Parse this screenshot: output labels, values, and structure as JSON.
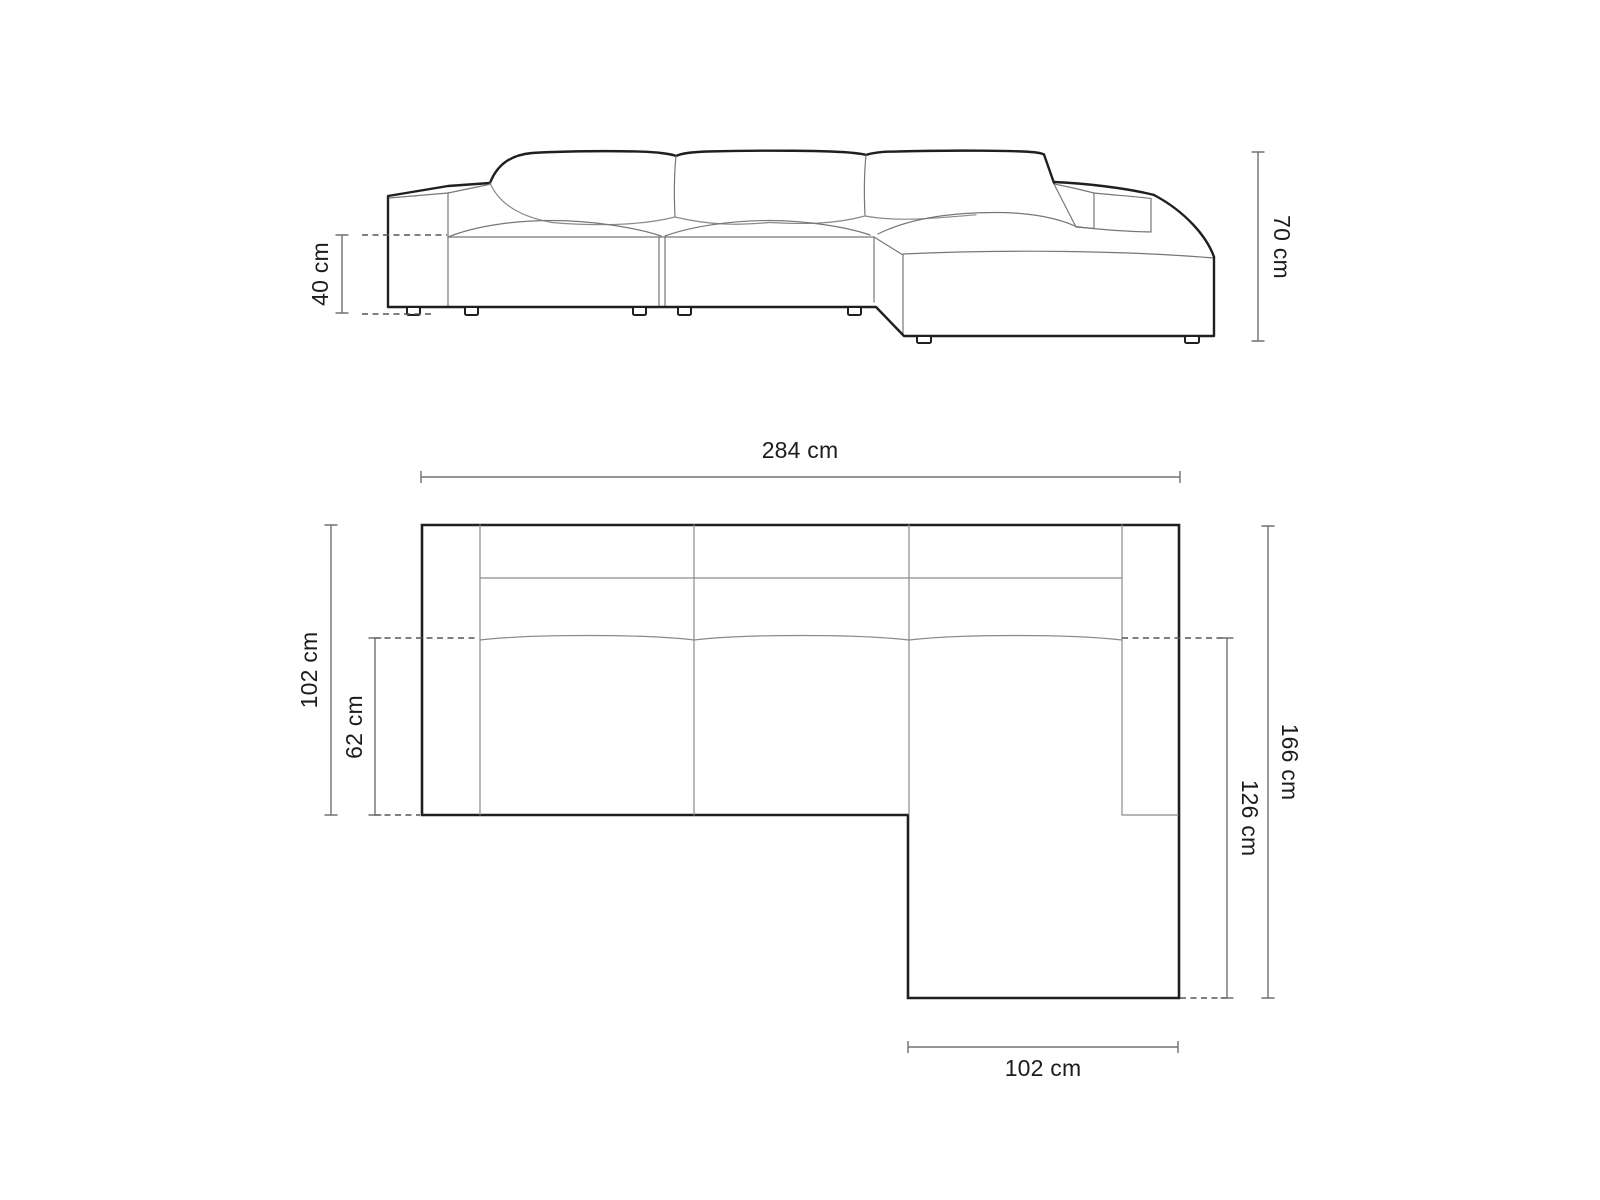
{
  "colors": {
    "background": "#ffffff",
    "outline": "#1f1f1f",
    "thin_line": "#8a8a8a",
    "dimension_line": "#707070",
    "dashed_line": "#555555",
    "text": "#1c1c1c"
  },
  "front_view": {
    "title": "sofa front elevation",
    "dimensions": {
      "seat_height": {
        "label": "40 cm",
        "value": 40,
        "unit": "cm"
      },
      "overall_height": {
        "label": "70 cm",
        "value": 70,
        "unit": "cm"
      }
    }
  },
  "plan_view": {
    "title": "sofa top plan",
    "dimensions": {
      "overall_width": {
        "label": "284 cm",
        "value": 284,
        "unit": "cm"
      },
      "main_depth": {
        "label": "102 cm",
        "value": 102,
        "unit": "cm"
      },
      "seat_depth": {
        "label": "62 cm",
        "value": 62,
        "unit": "cm"
      },
      "overall_depth": {
        "label": "166 cm",
        "value": 166,
        "unit": "cm"
      },
      "chaise_depth": {
        "label": "126 cm",
        "value": 126,
        "unit": "cm"
      },
      "chaise_width": {
        "label": "102 cm",
        "value": 102,
        "unit": "cm"
      }
    }
  }
}
